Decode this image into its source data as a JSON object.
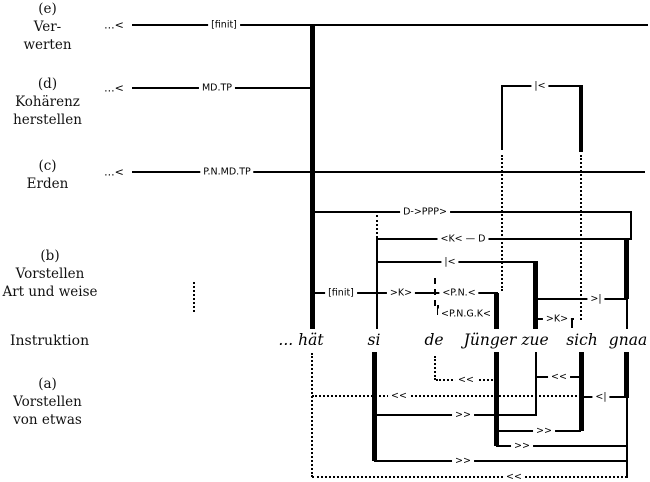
{
  "colors": {
    "ink": "#000000",
    "background": "#ffffff"
  },
  "sections": {
    "e": {
      "tag": "(e)",
      "line1": "Ver-",
      "line2": "werten"
    },
    "d": {
      "tag": "(d)",
      "line1": "Kohärenz",
      "line2": "herstellen"
    },
    "c": {
      "tag": "(c)",
      "line1": "Erden"
    },
    "b": {
      "tag": "(b)",
      "line1": "Vorstellen",
      "line2": "Art und weise"
    },
    "instruktion": "Instruktion",
    "a": {
      "tag": "(a)",
      "line1": "Vorstellen",
      "line2": "von etwas"
    }
  },
  "tier_labels": {
    "e_prefix": "...<",
    "e_finit": "[finit]",
    "d_prefix": "...<",
    "d_mdtp": "MD.TP",
    "d_bracket": "|<",
    "c_prefix": "...<",
    "c_pnmdtp": "P.N.MD.TP",
    "dppp": "D->PPP>",
    "kd": "<K< — D",
    "mid_bracket": "|<",
    "finit": "[finit]",
    "k_upper": ">K>",
    "pn": "<P.N.<",
    "pngk": "<P.N.G.K<",
    "gt_bar": ">|",
    "k_lower": ">K>"
  },
  "words": [
    "... hät",
    "si",
    "de",
    "Jünger",
    "zue",
    "sich",
    "gnaa"
  ],
  "arrows": {
    "zue_sich": "<<",
    "de_juenger": "<<",
    "long_left": "<<",
    "sich_gnaa": "<|",
    "si_zue": ">>",
    "juenger_sich": ">>",
    "juenger_gnaa": ">>",
    "si_gnaa": ">>",
    "bottom": "<<"
  }
}
